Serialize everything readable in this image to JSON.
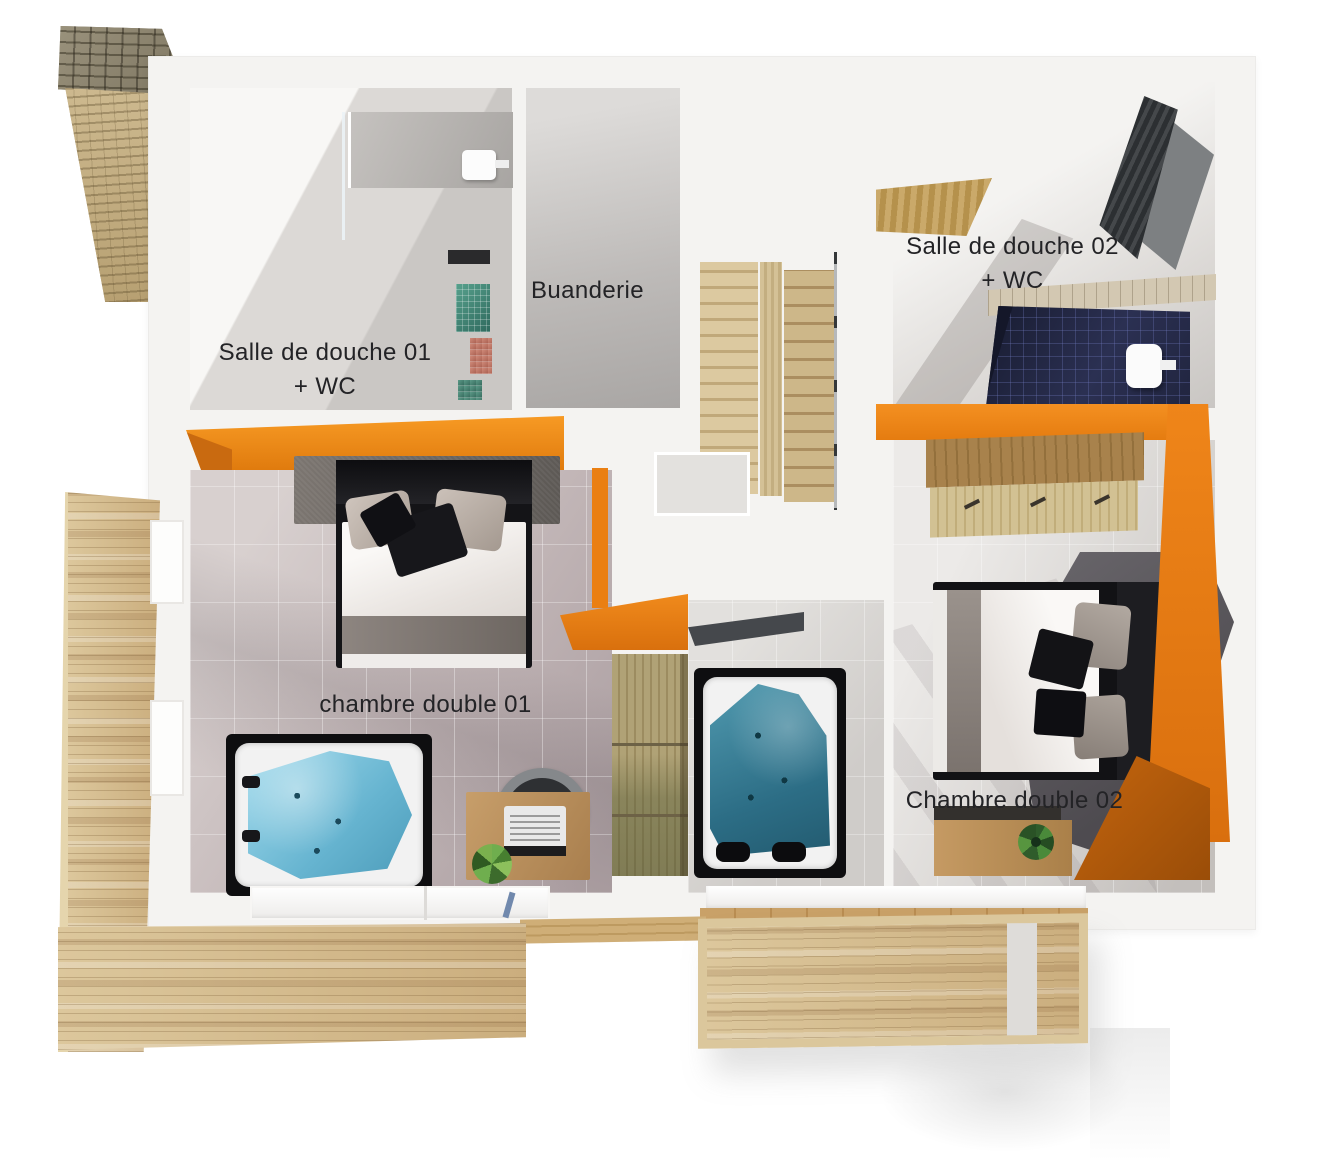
{
  "figure": {
    "kind": "3D floor plan rendering, top-down view of upper storey",
    "language": "fr"
  },
  "rooms": [
    {
      "id": "salle-de-douche-01",
      "label": "Salle de douche 01",
      "label2": "+ WC"
    },
    {
      "id": "buanderie",
      "label": "Buanderie"
    },
    {
      "id": "salle-de-douche-02",
      "label": "Salle de douche 02",
      "label2": "+ WC"
    },
    {
      "id": "chambre-double-01",
      "label": "chambre double 01"
    },
    {
      "id": "chambre-double-02",
      "label": "Chambre double 02"
    }
  ],
  "palette": {
    "accent_orange": "#EF8318",
    "accent_orange_dark": "#C96A10",
    "deck_wood": "#D3B98C",
    "stair_wood": "#D6C096",
    "spa_water_light": "#7EC5DE",
    "spa_water_dark": "#2F7088",
    "shower_tile_navy": "#262A44",
    "bedroom1_floor": "#C6BBBC",
    "bedroom2_floor": "#D8D5D2",
    "label_text": "#232326"
  },
  "objects": [
    "stone-chimney",
    "wood-staircase",
    "double-bed-01",
    "double-bed-02",
    "spa-tub-01",
    "spa-tub-02",
    "desk-with-laptop",
    "office-chair",
    "desk-with-plant",
    "wardrobe-01",
    "wardrobe-02",
    "shower-enclosure-01",
    "navy-mosaic-shower-02",
    "toilet",
    "wood-deck-left",
    "wood-deck-bottom",
    "balcony-deck-right"
  ]
}
